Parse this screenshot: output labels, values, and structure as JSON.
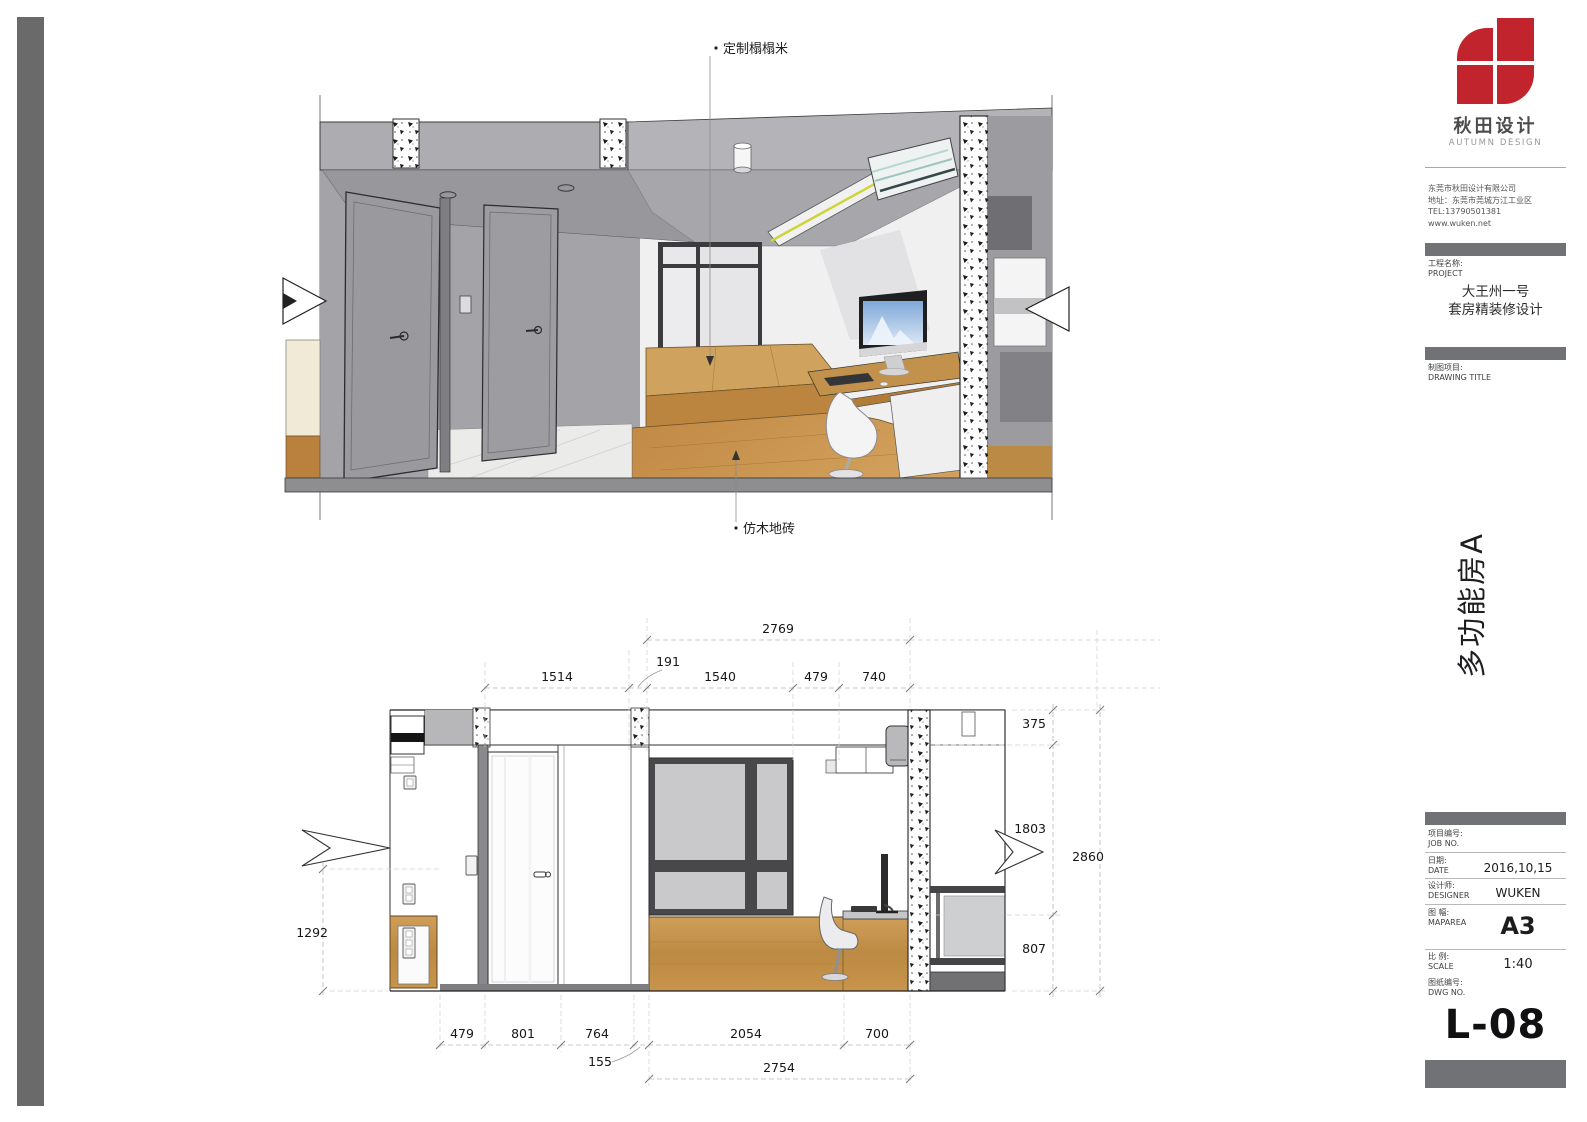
{
  "page": {
    "logo": {
      "cn": "秋田设计",
      "en": "AUTUMN DESIGN",
      "red": "#c2242e"
    },
    "company": {
      "line1": "东莞市秋田设计有限公司",
      "line2": "地址：东莞市莞城万江工业区",
      "line3": "TEL:13790501381",
      "line4": "www.wuken.net"
    },
    "project": {
      "label_cn": "工程名称:",
      "label_en": "PROJECT",
      "line1": "大王州一号",
      "line2": "套房精装修设计"
    },
    "drawing_title": {
      "label_cn": "制图项目:",
      "label_en": "DRAWING TITLE"
    },
    "vertical_title": "多功能房A",
    "fields": {
      "job": {
        "cn": "项目编号:",
        "en": "JOB NO.",
        "value": ""
      },
      "date": {
        "cn": "日期:",
        "en": "DATE",
        "value": "2016,10,15"
      },
      "designer": {
        "cn": "设计师:",
        "en": "DESIGNER",
        "value": "WUKEN"
      },
      "maparea": {
        "cn": "图 幅:",
        "en": "MAPAREA",
        "value": "A3"
      },
      "scale": {
        "cn": "比 例:",
        "en": "SCALE",
        "value": "1:40"
      },
      "dwg": {
        "cn": "图纸编号:",
        "en": "DWG NO.",
        "value": "L-08"
      }
    },
    "annotations": {
      "tatami_label": "定制榻榻米",
      "floor_label": "仿木地砖"
    },
    "dims": {
      "top_overall": "2769",
      "top_segments": {
        "a": "1514",
        "b": "191",
        "c": "1540",
        "d": "479",
        "e": "740"
      },
      "bottom_segments": {
        "a": "479",
        "b": "801",
        "c": "764",
        "d": "2054",
        "e": "700",
        "gap": "155"
      },
      "bottom_overall": "2754",
      "right": {
        "a": "375",
        "b": "1803",
        "c": "807",
        "overall": "2860"
      },
      "left": "1292"
    }
  }
}
